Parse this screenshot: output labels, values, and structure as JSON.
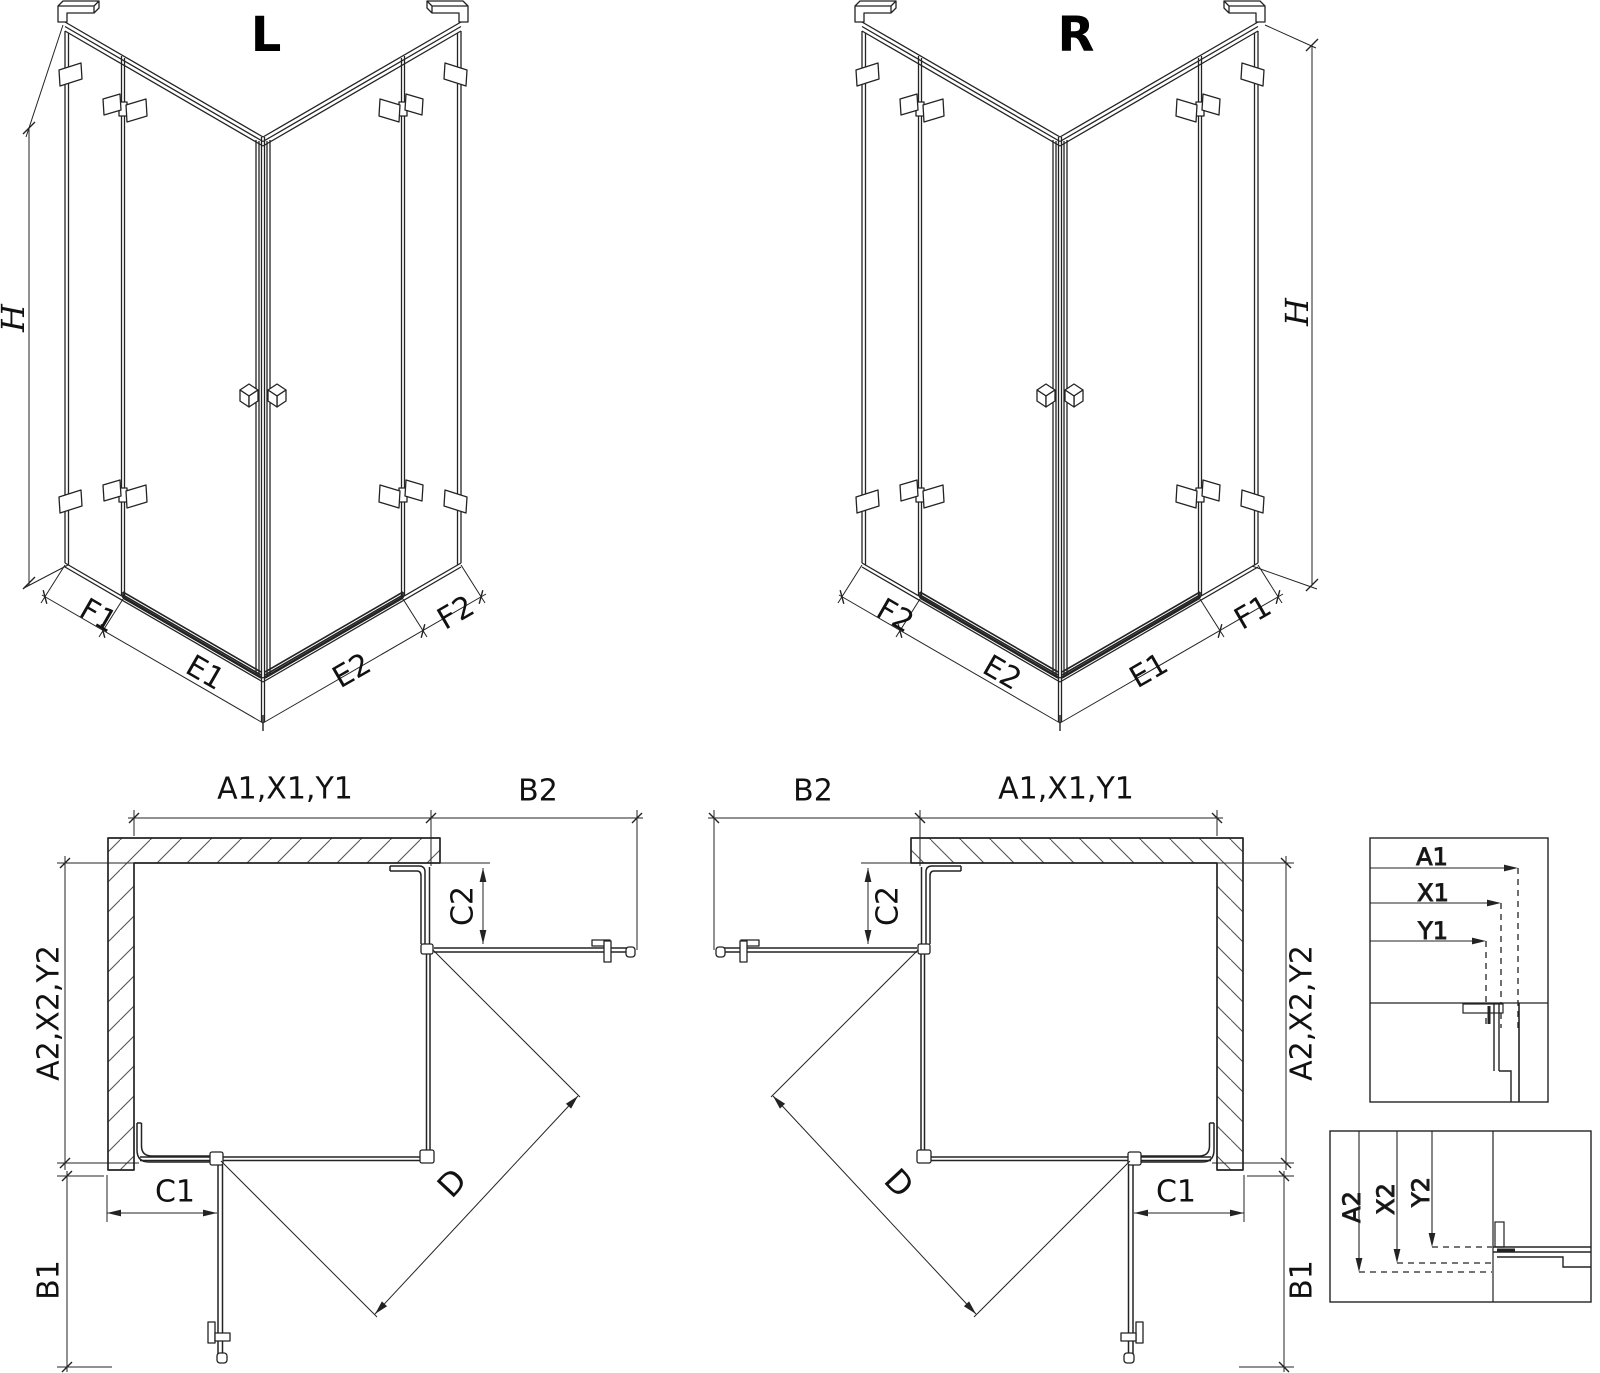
{
  "drawing": {
    "background": "#ffffff",
    "line_color": "#232323"
  },
  "iso_left": {
    "title": "L",
    "height_label": "H",
    "f1_label": "F1",
    "e1_label": "E1",
    "e2_label": "E2",
    "f2_label": "F2"
  },
  "iso_right": {
    "title": "R",
    "height_label": "H",
    "f2_label": "F2",
    "e2_label": "E2",
    "e1_label": "E1",
    "f1_label": "F1"
  },
  "plan_left": {
    "width_label": "A1,X1,Y1",
    "door2_width_label": "B2",
    "c2_label": "C2",
    "depth_label": "A2,X2,Y2",
    "c1_label": "C1",
    "door1_width_label": "B1",
    "diagonal_label": "D"
  },
  "plan_right": {
    "door2_width_label": "B2",
    "width_label": "A1,X1,Y1",
    "c2_label": "C2",
    "depth_label": "A2,X2,Y2",
    "c1_label": "C1",
    "door1_width_label": "B1",
    "diagonal_label": "D"
  },
  "detail_width": {
    "a_label": "A1",
    "x_label": "X1",
    "y_label": "Y1"
  },
  "detail_depth": {
    "a_label": "A2",
    "x_label": "X2",
    "y_label": "Y2"
  }
}
